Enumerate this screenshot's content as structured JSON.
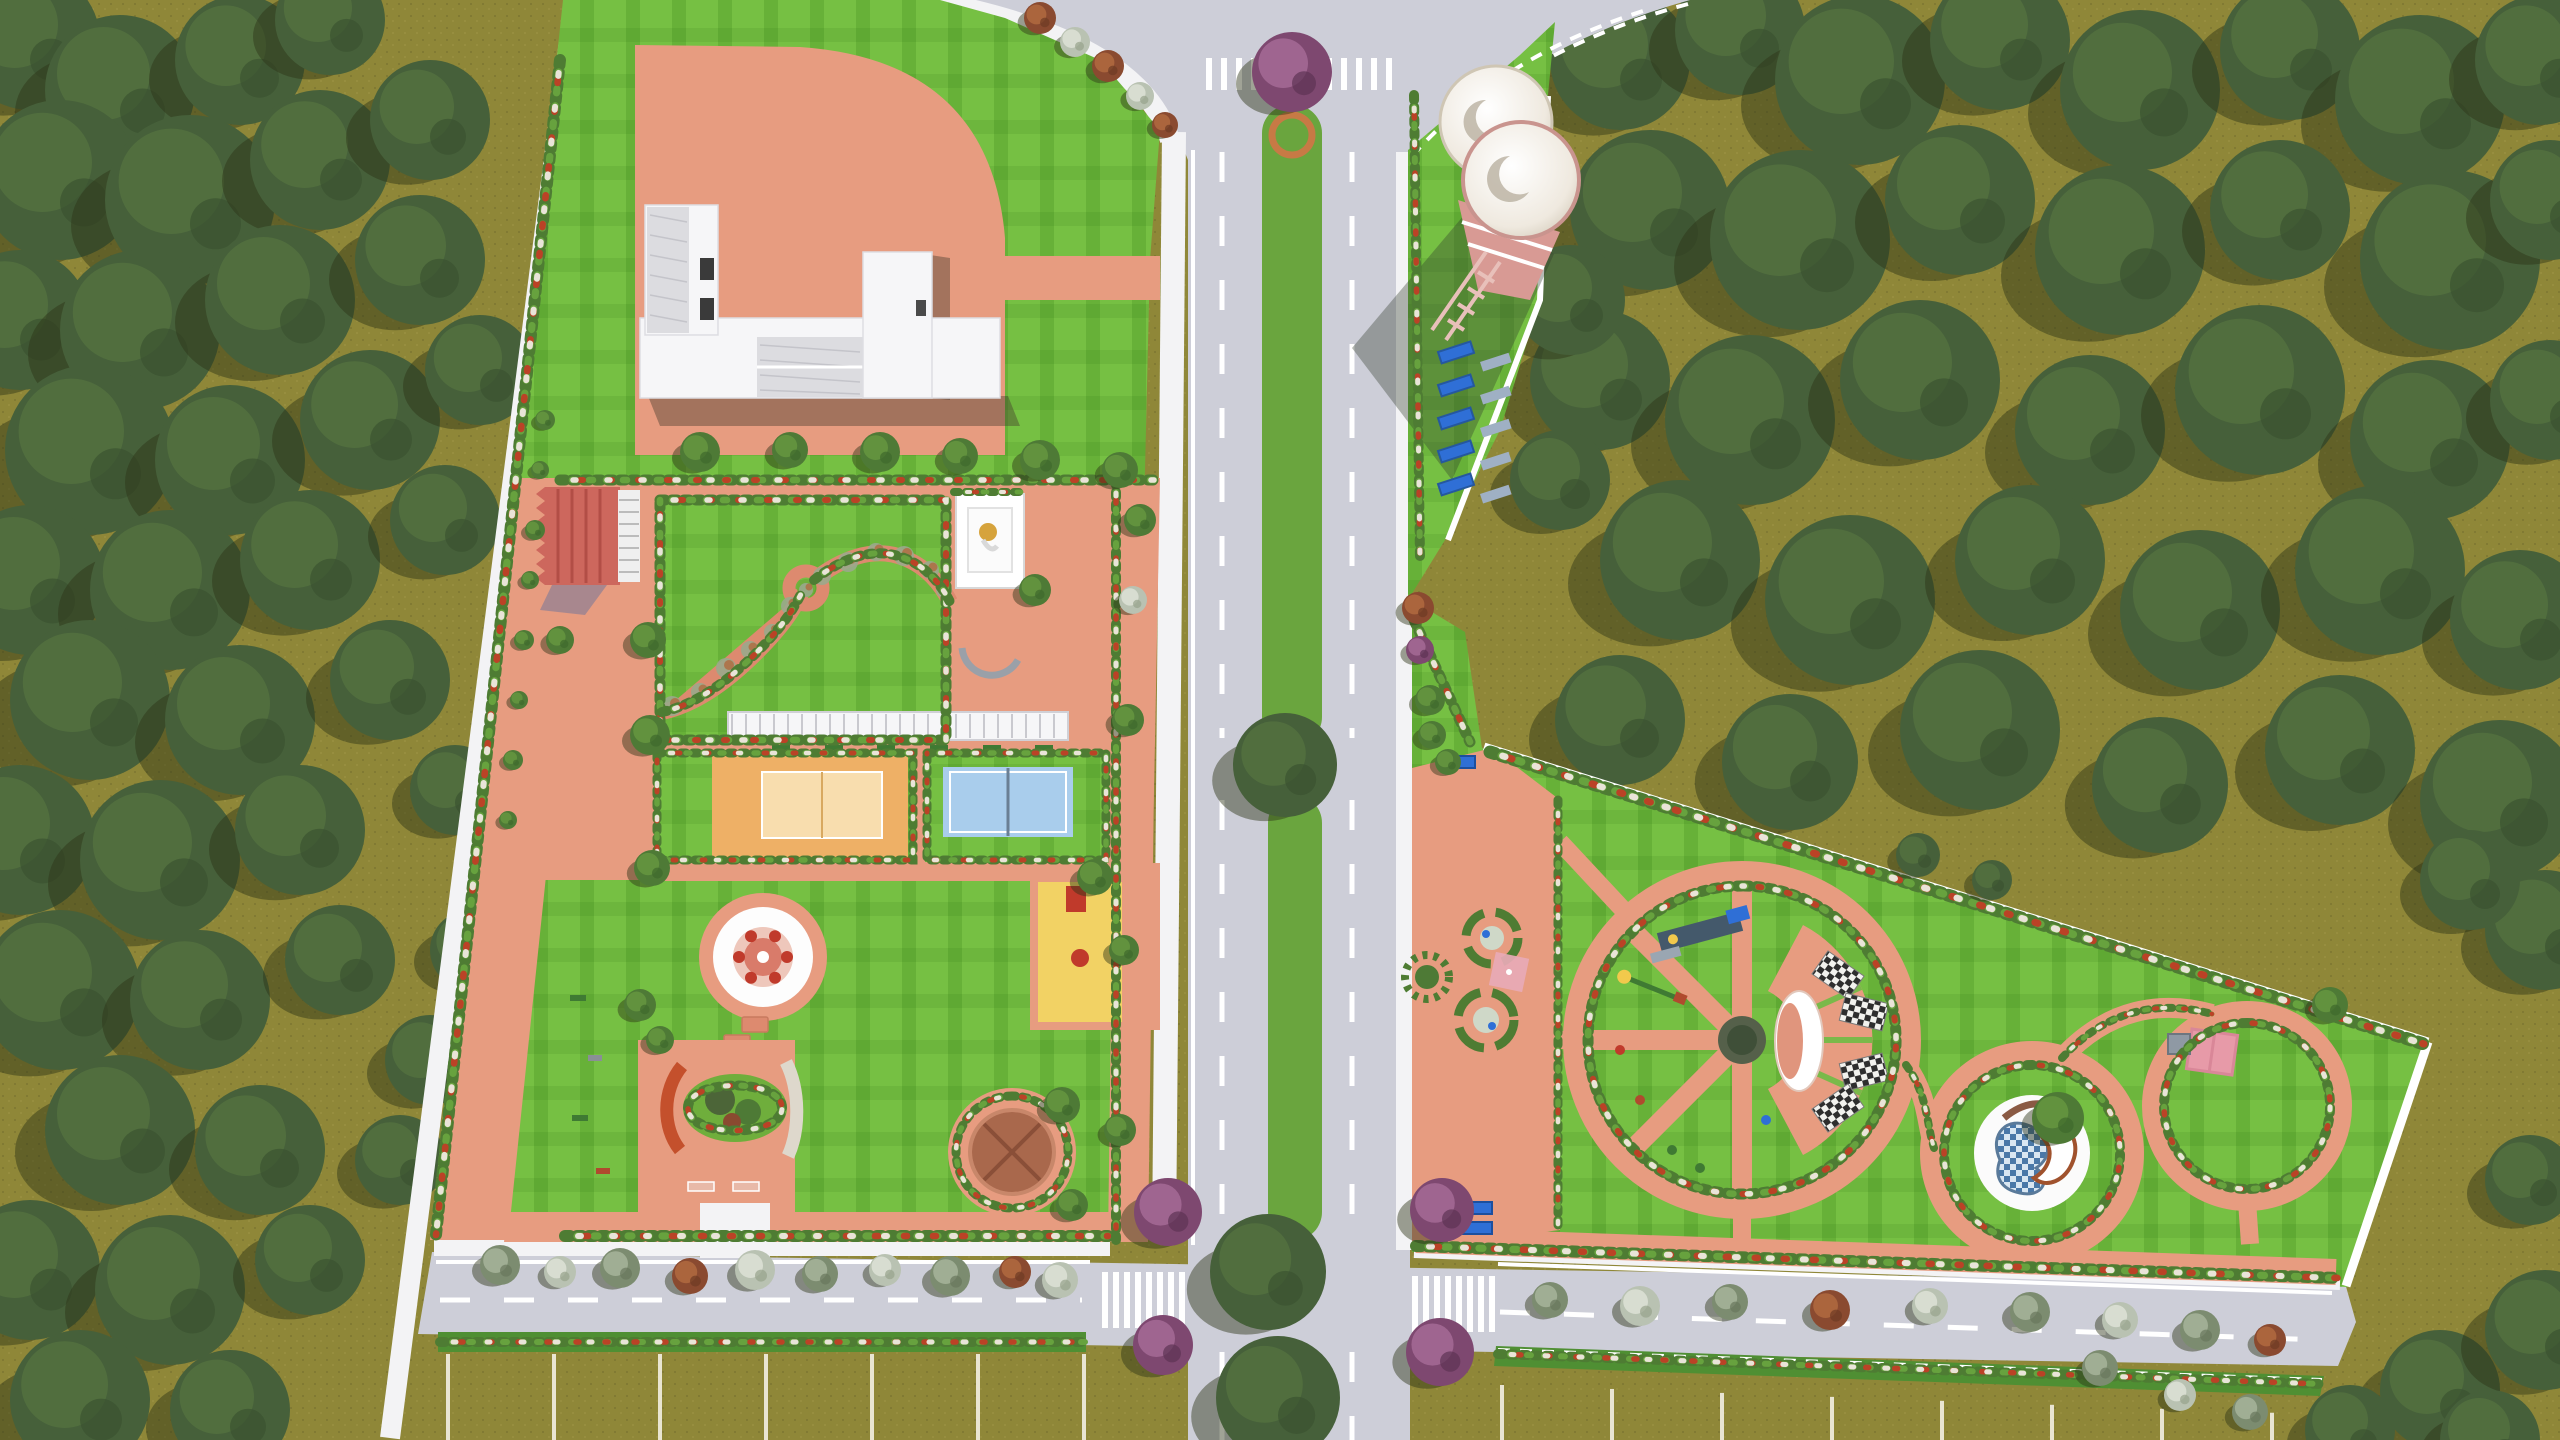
{
  "meta": {
    "scene": "aerial-landscape-master-plan-3d-render",
    "view": "top-down",
    "tagline": ""
  },
  "colors": {
    "olive": "#8f8738",
    "oliveDot": "#6f692c",
    "road": "#cdced8",
    "sidewalk": "#f3f3f5",
    "lawn": "#76c043",
    "lawnStripe": "rgba(35,110,8,0.18)",
    "lawnStripe2": "rgba(30,100,10,0.10)",
    "pink": "#e79c80",
    "pinkDeep": "#dd8a6f",
    "redRoof": "#cd675d",
    "median": "#6aa53e",
    "court1": "#eeb066",
    "court1In": "#f8ddae",
    "court2": "#a9cdec",
    "yellow": "#f2d264",
    "red": "#c03a2b",
    "blue": "#2f6fd6",
    "gold": "#d6a33c",
    "dome": "#a9684c",
    "tank": "#efe9df",
    "tankBase": "#d89a94",
    "hedge": "#4e7c33",
    "flowerRed": "#bb4226",
    "flowerWhite": "#e9e4d8",
    "treeDark": "#3e5430",
    "treeMid": "#4c6538",
    "treeLight": "#617d44",
    "treeShadow": "rgba(45,50,22,0.45)"
  },
  "tree_palettes": {
    "forest": [
      "#46603a",
      "#54713f",
      "#3a5230"
    ],
    "green": [
      "#4e7a36",
      "#66963f",
      "#3f6a2c"
    ],
    "gray": [
      "#7c8c70",
      "#a7b49a",
      "#68765d"
    ],
    "white": [
      "#b9c2b2",
      "#dde2d6",
      "#97a38c"
    ],
    "purple": [
      "#7e4870",
      "#a46b95",
      "#5e3354"
    ],
    "rust": [
      "#8a4a30",
      "#b06a3f",
      "#6e3a24"
    ]
  },
  "forest": {
    "left": [
      [
        30,
        40,
        70
      ],
      [
        120,
        90,
        75
      ],
      [
        240,
        60,
        65
      ],
      [
        330,
        20,
        55
      ],
      [
        60,
        180,
        80
      ],
      [
        190,
        200,
        85
      ],
      [
        320,
        160,
        70
      ],
      [
        430,
        120,
        60
      ],
      [
        20,
        320,
        70
      ],
      [
        140,
        330,
        80
      ],
      [
        280,
        300,
        75
      ],
      [
        420,
        260,
        65
      ],
      [
        90,
        450,
        85
      ],
      [
        230,
        460,
        75
      ],
      [
        370,
        420,
        70
      ],
      [
        480,
        370,
        55
      ],
      [
        30,
        580,
        75
      ],
      [
        170,
        590,
        80
      ],
      [
        310,
        560,
        70
      ],
      [
        445,
        520,
        55
      ],
      [
        90,
        700,
        80
      ],
      [
        240,
        720,
        75
      ],
      [
        390,
        680,
        60
      ],
      [
        20,
        840,
        75
      ],
      [
        160,
        860,
        80
      ],
      [
        300,
        830,
        65
      ],
      [
        60,
        990,
        80
      ],
      [
        200,
        1000,
        70
      ],
      [
        340,
        960,
        55
      ],
      [
        120,
        1130,
        75
      ],
      [
        260,
        1150,
        65
      ],
      [
        30,
        1270,
        70
      ],
      [
        170,
        1290,
        75
      ],
      [
        310,
        1260,
        55
      ],
      [
        80,
        1400,
        70
      ],
      [
        230,
        1410,
        60
      ],
      [
        400,
        1160,
        45
      ],
      [
        455,
        790,
        45
      ],
      [
        470,
        950,
        40
      ],
      [
        430,
        1060,
        45
      ]
    ],
    "topRight": [
      [
        1620,
        60,
        70
      ],
      [
        1740,
        30,
        65
      ],
      [
        1860,
        80,
        85
      ],
      [
        2000,
        40,
        70
      ],
      [
        2140,
        90,
        80
      ],
      [
        2290,
        50,
        70
      ],
      [
        2420,
        100,
        85
      ],
      [
        2540,
        60,
        65
      ],
      [
        1650,
        210,
        80
      ],
      [
        1800,
        240,
        90
      ],
      [
        1960,
        200,
        75
      ],
      [
        2120,
        250,
        85
      ],
      [
        2280,
        210,
        70
      ],
      [
        2450,
        260,
        90
      ],
      [
        2550,
        200,
        60
      ],
      [
        1600,
        380,
        70
      ],
      [
        1750,
        420,
        85
      ],
      [
        1920,
        380,
        80
      ],
      [
        2090,
        430,
        75
      ],
      [
        2260,
        390,
        85
      ],
      [
        2430,
        440,
        80
      ],
      [
        2550,
        400,
        60
      ],
      [
        1680,
        560,
        80
      ],
      [
        1850,
        600,
        85
      ],
      [
        2030,
        560,
        75
      ],
      [
        2200,
        610,
        80
      ],
      [
        2380,
        570,
        85
      ],
      [
        2520,
        620,
        70
      ],
      [
        1620,
        720,
        65
      ],
      [
        1790,
        762,
        68
      ],
      [
        1980,
        730,
        80
      ],
      [
        2160,
        785,
        68
      ],
      [
        2340,
        750,
        75
      ],
      [
        2500,
        800,
        80
      ],
      [
        2545,
        930,
        60
      ],
      [
        2470,
        880,
        50
      ],
      [
        1570,
        300,
        55
      ],
      [
        1560,
        480,
        50
      ]
    ],
    "bottomRight": [
      [
        2440,
        1390,
        60
      ],
      [
        2545,
        1330,
        60
      ],
      [
        2350,
        1430,
        45
      ],
      [
        2530,
        1180,
        45
      ],
      [
        2490,
        1440,
        50
      ]
    ]
  },
  "ornamental_trees": [
    [
      1040,
      18,
      16,
      "rust"
    ],
    [
      1075,
      42,
      15,
      "white"
    ],
    [
      1108,
      66,
      16,
      "rust"
    ],
    [
      1140,
      96,
      14,
      "white"
    ],
    [
      1165,
      125,
      13,
      "rust"
    ],
    [
      700,
      452,
      20,
      "green"
    ],
    [
      790,
      450,
      18,
      "green"
    ],
    [
      880,
      452,
      20,
      "green"
    ],
    [
      960,
      456,
      18,
      "green"
    ],
    [
      1040,
      460,
      20,
      "green"
    ],
    [
      1120,
      470,
      18,
      "green"
    ],
    [
      648,
      640,
      18,
      "green"
    ],
    [
      650,
      735,
      20,
      "green"
    ],
    [
      652,
      868,
      18,
      "green"
    ],
    [
      640,
      1005,
      16,
      "green"
    ],
    [
      560,
      640,
      14,
      "green"
    ],
    [
      1140,
      520,
      16,
      "green"
    ],
    [
      1133,
      600,
      14,
      "white"
    ],
    [
      1128,
      720,
      16,
      "green"
    ],
    [
      1124,
      950,
      15,
      "green"
    ],
    [
      1120,
      1130,
      16,
      "green"
    ],
    [
      1095,
      877,
      18,
      "green"
    ],
    [
      1035,
      590,
      16,
      "green"
    ],
    [
      1062,
      1105,
      18,
      "green"
    ],
    [
      1072,
      1205,
      16,
      "green"
    ],
    [
      660,
      1040,
      14,
      "green"
    ],
    [
      500,
      1265,
      20,
      "gray"
    ],
    [
      560,
      1272,
      16,
      "white"
    ],
    [
      620,
      1268,
      20,
      "gray"
    ],
    [
      690,
      1276,
      18,
      "rust"
    ],
    [
      755,
      1270,
      20,
      "white"
    ],
    [
      820,
      1274,
      18,
      "gray"
    ],
    [
      885,
      1270,
      16,
      "white"
    ],
    [
      950,
      1276,
      20,
      "gray"
    ],
    [
      1015,
      1272,
      16,
      "rust"
    ],
    [
      1060,
      1280,
      18,
      "white"
    ],
    [
      1168,
      1212,
      34,
      "purple"
    ],
    [
      1163,
      1345,
      30,
      "purple"
    ],
    [
      1442,
      1210,
      32,
      "purple"
    ],
    [
      1440,
      1352,
      34,
      "purple"
    ],
    [
      1550,
      1300,
      18,
      "gray"
    ],
    [
      1640,
      1306,
      20,
      "white"
    ],
    [
      1730,
      1302,
      18,
      "gray"
    ],
    [
      1830,
      1310,
      20,
      "rust"
    ],
    [
      1930,
      1306,
      18,
      "white"
    ],
    [
      2030,
      1312,
      20,
      "gray"
    ],
    [
      2120,
      1320,
      18,
      "white"
    ],
    [
      2200,
      1330,
      20,
      "gray"
    ],
    [
      2270,
      1340,
      16,
      "rust"
    ],
    [
      2100,
      1368,
      18,
      "gray"
    ],
    [
      2180,
      1395,
      16,
      "white"
    ],
    [
      2250,
      1412,
      18,
      "gray"
    ],
    [
      1418,
      608,
      16,
      "rust"
    ],
    [
      1420,
      650,
      14,
      "purple"
    ],
    [
      1430,
      700,
      15,
      "green"
    ],
    [
      1432,
      735,
      14,
      "green"
    ],
    [
      1448,
      762,
      13,
      "green"
    ],
    [
      545,
      420,
      10,
      "green"
    ],
    [
      540,
      470,
      9,
      "green"
    ],
    [
      535,
      530,
      10,
      "green"
    ],
    [
      530,
      580,
      9,
      "green"
    ],
    [
      524,
      640,
      10,
      "green"
    ],
    [
      519,
      700,
      9,
      "green"
    ],
    [
      513,
      760,
      10,
      "green"
    ],
    [
      508,
      820,
      9,
      "green"
    ],
    [
      2058,
      1118,
      26,
      "green"
    ],
    [
      1918,
      855,
      22,
      "forest"
    ],
    [
      1992,
      880,
      20,
      "forest"
    ],
    [
      2330,
      1005,
      18,
      "green"
    ]
  ],
  "median": {
    "segments": [
      [
        1262,
        105,
        60,
        640
      ],
      [
        1268,
        795,
        54,
        445
      ],
      [
        1262,
        1348,
        60,
        92
      ]
    ],
    "big_trees": [
      [
        1285,
        765,
        52
      ],
      [
        1268,
        1272,
        58
      ],
      [
        1278,
        1398,
        62
      ]
    ],
    "purple_tree": [
      1292,
      72,
      40
    ],
    "planter_ring": [
      1292,
      135,
      20
    ]
  },
  "crosswalks": [
    {
      "x": 1206,
      "y": 58,
      "count": 13,
      "step": 15,
      "w": 6,
      "h": 32
    },
    {
      "x": 1102,
      "y": 1272,
      "count": 8,
      "step": 11,
      "w": 6,
      "h": 56
    },
    {
      "x": 1412,
      "y": 1276,
      "count": 8,
      "step": 11,
      "w": 6,
      "h": 56
    }
  ],
  "lane_dashes": [
    [
      1222,
      152,
      1222,
      738
    ],
    [
      1352,
      152,
      1352,
      738
    ],
    [
      1222,
      800,
      1222,
      1238
    ],
    [
      1352,
      800,
      1352,
      1238
    ],
    [
      1222,
      1352,
      1222,
      1440
    ],
    [
      1352,
      1352,
      1352,
      1440
    ],
    [
      440,
      1300,
      1082,
      1300
    ],
    [
      1500,
      1312,
      2324,
      1340
    ]
  ],
  "parking": {
    "left": {
      "x1": 448,
      "x2": 1085,
      "y": 1354,
      "len": 86,
      "step": 106
    },
    "right": {
      "x1": 1502,
      "x2": 2318,
      "y": 1385,
      "len": 55,
      "step": 110
    }
  },
  "water_tower": {
    "tanks": [
      [
        1496,
        122,
        56
      ],
      [
        1521,
        180,
        58
      ]
    ],
    "benches": {
      "x": 1438,
      "y": 352,
      "rows": 5,
      "step": 33
    }
  },
  "pergola_benches": {
    "y": 745,
    "xs": [
      772,
      825,
      877,
      930,
      983,
      1035
    ]
  },
  "step_stones": [
    [
      755,
      1025
    ],
    [
      737,
      1043
    ],
    [
      751,
      1061
    ],
    [
      729,
      1079
    ],
    [
      743,
      1097
    ],
    [
      719,
      1113
    ],
    [
      733,
      1130
    ],
    [
      707,
      1146
    ]
  ],
  "wheel": {
    "cx": 1742,
    "cy": 1040,
    "r": 168,
    "spoke_ends": [
      [
        1742,
        872
      ],
      [
        1623,
        921
      ],
      [
        1574,
        1040
      ],
      [
        1623,
        1159
      ],
      [
        1742,
        1208
      ]
    ]
  },
  "ring2": {
    "cx": 2032,
    "cy": 1153,
    "r": 100
  },
  "loop3": {
    "cx": 2247,
    "cy": 1106,
    "r": 95
  },
  "checker_mats": [
    [
      1838,
      975,
      35
    ],
    [
      1864,
      1012,
      14
    ],
    [
      1864,
      1072,
      -14
    ],
    [
      1838,
      1108,
      -35
    ]
  ],
  "hedges": [
    {
      "d": "M560,60 L436,1235",
      "w": 12,
      "f": true
    },
    {
      "d": "M565,1236 L1108,1236",
      "w": 12,
      "f": true
    },
    {
      "d": "M660,500 L946,500 L946,740 L660,740 Z",
      "w": 11,
      "f": true
    },
    {
      "d": "M657,753 L913,753 L913,860 L657,860 Z",
      "w": 9,
      "f": true
    },
    {
      "d": "M927,753 L1106,753 L1106,860 L927,860 Z",
      "w": 9,
      "f": true
    },
    {
      "d": "M1116,480 L1116,1240",
      "w": 10,
      "f": true
    },
    {
      "d": "M560,480 L1158,480",
      "w": 11,
      "f": true
    },
    {
      "d": "M662,712 C700,704 736,674 762,647 C788,620 796,604 802,592",
      "w": 10,
      "f": true
    },
    {
      "d": "M814,580 C842,558 872,548 898,556 C926,564 942,586 950,602",
      "w": 10,
      "f": true
    },
    {
      "d": "M688,1108 C688,1078 782,1078 782,1108 C782,1138 688,1138 688,1108 Z",
      "w": 10,
      "f": true
    },
    {
      "d": "M1490,752 L2424,1044",
      "w": 13,
      "f": true
    },
    {
      "d": "M1416,1246 L2338,1278",
      "w": 12,
      "f": true
    },
    {
      "d": "M1742,886 a154,154 0 1 0 0.1,0",
      "w": 11,
      "f": true
    },
    {
      "d": "M2032,1065 a88,88 0 1 0 0.1,0",
      "w": 10,
      "f": true
    },
    {
      "d": "M2247,1023 a83,83 0 1 0 0.1,0",
      "w": 10,
      "f": true
    },
    {
      "d": "M1414,95 L1420,560",
      "w": 10,
      "f": true
    },
    {
      "d": "M1414,620 L1470,742",
      "w": 11,
      "f": true
    },
    {
      "d": "M1558,800 L1558,1225",
      "w": 9,
      "f": true
    },
    {
      "d": "M1012,1096 a56,56 0 1 0 0.1,0",
      "w": 9,
      "f": true
    },
    {
      "d": "M440,1342 L1085,1342",
      "w": 10,
      "f": true
    },
    {
      "d": "M1498,1354 L2322,1384",
      "w": 10,
      "f": true
    },
    {
      "d": "M954,492 L1026,492",
      "w": 8,
      "f": true
    },
    {
      "d": "M1906,1065 C1928,1095 1926,1122 1934,1148",
      "w": 8,
      "f": true
    },
    {
      "d": "M2062,1058 C2108,1008 2162,1000 2212,1014",
      "w": 8,
      "f": true
    },
    {
      "d": "M1292,130 L1292,730",
      "w": 12,
      "f": false
    },
    {
      "d": "M1290,800 L1276,1235",
      "w": 12,
      "f": false
    }
  ],
  "garden_shrubs": [
    [
      672,
      706,
      10
    ],
    [
      700,
      692,
      9
    ],
    [
      726,
      668,
      10
    ],
    [
      750,
      650,
      9
    ],
    [
      772,
      632,
      8
    ],
    [
      790,
      606,
      9
    ],
    [
      822,
      576,
      9
    ],
    [
      848,
      562,
      10
    ],
    [
      876,
      552,
      9
    ],
    [
      904,
      556,
      10
    ],
    [
      930,
      570,
      9
    ],
    [
      944,
      590,
      8
    ],
    [
      806,
      590,
      7
    ]
  ],
  "play_items": [
    [
      1640,
      1100
    ],
    [
      1700,
      1168
    ],
    [
      1620,
      1050
    ],
    [
      1766,
      1120
    ],
    [
      1672,
      1150
    ]
  ]
}
